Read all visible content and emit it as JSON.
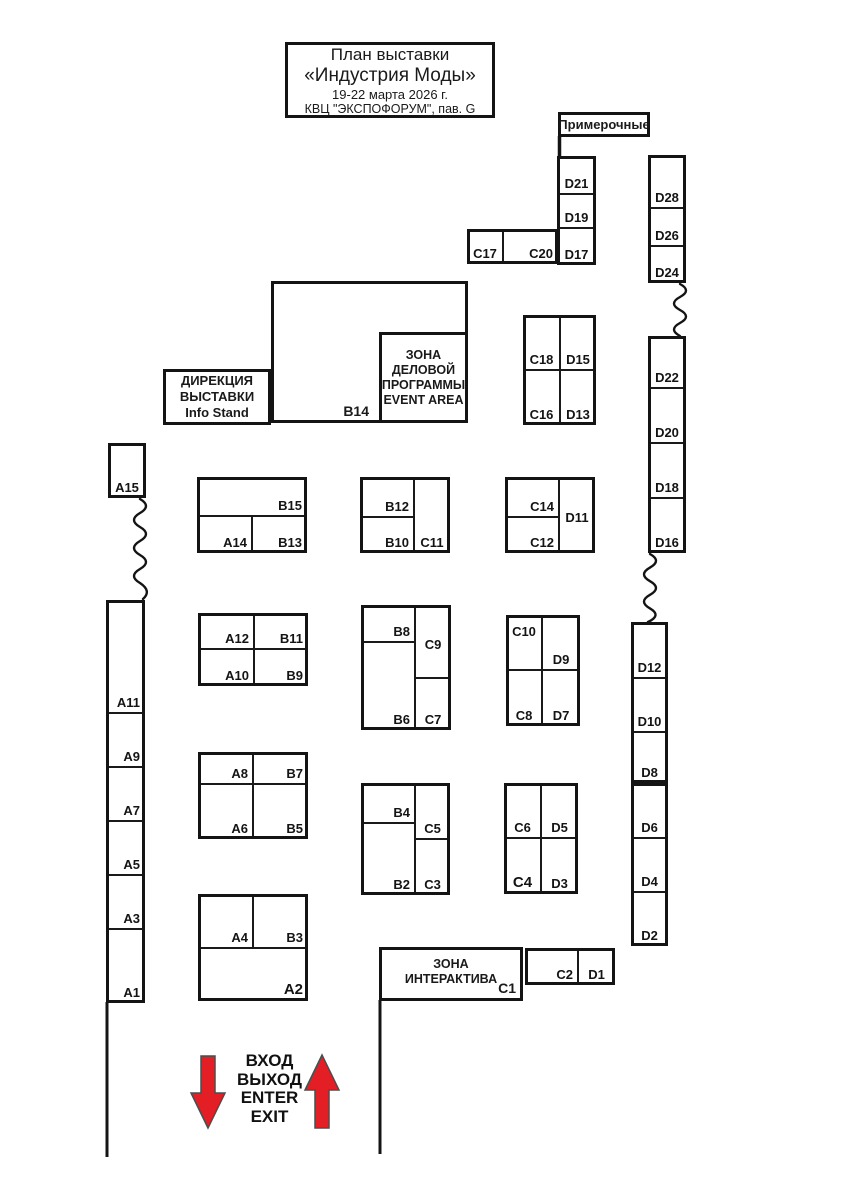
{
  "title": {
    "line1": "План выставки",
    "line2": "«Индустрия Моды»",
    "line3": "19-22 марта 2026 г.",
    "line4": "КВЦ \"ЭКСПОФОРУМ\", пав. G"
  },
  "labels": {
    "dressing_rooms": "Примерочные",
    "direction_line1": "ДИРЕКЦИЯ",
    "direction_line2": "ВЫСТАВКИ",
    "direction_line3": "Info Stand",
    "event_line1": "ЗОНА",
    "event_line2": "ДЕЛОВОЙ",
    "event_line3": "ПРОГРАММЫ",
    "event_line4": "EVENT AREA",
    "interactive_line1": "ЗОНА",
    "interactive_line2": "ИНТЕРАКТИВА",
    "interactive_booth": "C1",
    "b14": "B14",
    "entrance_line1": "ВХОД",
    "entrance_line2": "ВЫХОД",
    "entrance_line3": "ENTER",
    "entrance_line4": "EXIT"
  },
  "colors": {
    "accent_red": "#e31e24",
    "ink": "#141414",
    "background": "#ffffff"
  },
  "blocks": [
    {
      "name": "d21-column",
      "rect": [
        557,
        156,
        39,
        109
      ],
      "cells": [
        {
          "id": "D21",
          "rect": [
            557,
            156,
            39,
            38
          ],
          "pos": "bc"
        },
        {
          "id": "D19",
          "rect": [
            557,
            194,
            39,
            34
          ],
          "pos": "bc"
        },
        {
          "id": "D17",
          "rect": [
            557,
            228,
            39,
            37
          ],
          "pos": "bc"
        }
      ]
    },
    {
      "name": "c17-block",
      "rect": [
        467,
        229,
        91,
        35
      ],
      "cells": [
        {
          "id": "C17",
          "rect": [
            467,
            229,
            36,
            35
          ],
          "pos": "bc"
        },
        {
          "id": "C20",
          "rect": [
            503,
            229,
            55,
            35
          ],
          "pos": "br"
        }
      ]
    },
    {
      "name": "d28-column",
      "rect": [
        648,
        155,
        38,
        128
      ],
      "cells": [
        {
          "id": "D28",
          "rect": [
            648,
            155,
            38,
            53
          ],
          "pos": "bc"
        },
        {
          "id": "D26",
          "rect": [
            648,
            208,
            38,
            38
          ],
          "pos": "bc"
        },
        {
          "id": "D24",
          "rect": [
            648,
            246,
            38,
            37
          ],
          "pos": "bc"
        }
      ]
    },
    {
      "name": "d22-column",
      "rect": [
        648,
        336,
        38,
        217
      ],
      "cells": [
        {
          "id": "D22",
          "rect": [
            648,
            336,
            38,
            52
          ],
          "pos": "bc"
        },
        {
          "id": "D20",
          "rect": [
            648,
            388,
            38,
            55
          ],
          "pos": "bc"
        },
        {
          "id": "D18",
          "rect": [
            648,
            443,
            38,
            55
          ],
          "pos": "bc"
        },
        {
          "id": "D16",
          "rect": [
            648,
            498,
            38,
            55
          ],
          "pos": "bc"
        }
      ]
    },
    {
      "name": "d12-column",
      "rect": [
        631,
        622,
        37,
        161
      ],
      "cells": [
        {
          "id": "D12",
          "rect": [
            631,
            622,
            37,
            56
          ],
          "pos": "bc"
        },
        {
          "id": "D10",
          "rect": [
            631,
            678,
            37,
            54
          ],
          "pos": "bc"
        },
        {
          "id": "D8",
          "rect": [
            631,
            732,
            37,
            51
          ],
          "pos": "bc"
        }
      ]
    },
    {
      "name": "d6-column",
      "rect": [
        631,
        783,
        37,
        163
      ],
      "cells": [
        {
          "id": "D6",
          "rect": [
            631,
            783,
            37,
            55
          ],
          "pos": "bc"
        },
        {
          "id": "D4",
          "rect": [
            631,
            838,
            37,
            54
          ],
          "pos": "bc"
        },
        {
          "id": "D2",
          "rect": [
            631,
            892,
            37,
            54
          ],
          "pos": "bc"
        }
      ]
    },
    {
      "name": "c18-block",
      "rect": [
        523,
        315,
        73,
        110
      ],
      "cells": [
        {
          "id": "C18",
          "rect": [
            523,
            315,
            37,
            55
          ],
          "pos": "bc"
        },
        {
          "id": "D15",
          "rect": [
            560,
            315,
            36,
            55
          ],
          "pos": "bc"
        },
        {
          "id": "C16",
          "rect": [
            523,
            370,
            37,
            55
          ],
          "pos": "bc"
        },
        {
          "id": "D13",
          "rect": [
            560,
            370,
            36,
            55
          ],
          "pos": "bc"
        }
      ]
    },
    {
      "name": "a15-box",
      "rect": [
        108,
        443,
        38,
        55
      ],
      "cells": [
        {
          "id": "A15",
          "rect": [
            108,
            443,
            38,
            55
          ],
          "pos": "bc"
        }
      ]
    },
    {
      "name": "a-column",
      "rect": [
        106,
        600,
        39,
        403
      ],
      "cells": [
        {
          "id": "A11",
          "rect": [
            106,
            600,
            39,
            113
          ],
          "pos": "br"
        },
        {
          "id": "A9",
          "rect": [
            106,
            713,
            39,
            54
          ],
          "pos": "br"
        },
        {
          "id": "A7",
          "rect": [
            106,
            767,
            39,
            54
          ],
          "pos": "br"
        },
        {
          "id": "A5",
          "rect": [
            106,
            821,
            39,
            54
          ],
          "pos": "br"
        },
        {
          "id": "A3",
          "rect": [
            106,
            875,
            39,
            54
          ],
          "pos": "br"
        },
        {
          "id": "A1",
          "rect": [
            106,
            929,
            39,
            74
          ],
          "pos": "br"
        }
      ]
    },
    {
      "name": "row1-block1",
      "rect": [
        197,
        477,
        110,
        76
      ],
      "cells": [
        {
          "id": "B15",
          "rect": [
            197,
            477,
            110,
            39
          ],
          "pos": "br"
        },
        {
          "id": "A14",
          "rect": [
            197,
            516,
            55,
            37
          ],
          "pos": "br"
        },
        {
          "id": "B13",
          "rect": [
            252,
            516,
            55,
            37
          ],
          "pos": "br"
        }
      ]
    },
    {
      "name": "row1-block2",
      "rect": [
        360,
        477,
        90,
        76
      ],
      "cells": [
        {
          "id": "B12",
          "rect": [
            360,
            477,
            54,
            40
          ],
          "pos": "br"
        },
        {
          "id": "B10",
          "rect": [
            360,
            517,
            54,
            36
          ],
          "pos": "br"
        },
        {
          "id": "C11",
          "rect": [
            414,
            477,
            36,
            76
          ],
          "pos": "bc"
        }
      ]
    },
    {
      "name": "row1-block3",
      "rect": [
        505,
        477,
        90,
        76
      ],
      "cells": [
        {
          "id": "C14",
          "rect": [
            505,
            477,
            54,
            40
          ],
          "pos": "br"
        },
        {
          "id": "C12",
          "rect": [
            505,
            517,
            54,
            36
          ],
          "pos": "br"
        },
        {
          "id": "D11",
          "rect": [
            559,
            477,
            36,
            76
          ],
          "pos": "c"
        }
      ]
    },
    {
      "name": "row2-block1",
      "rect": [
        198,
        613,
        110,
        73
      ],
      "cells": [
        {
          "id": "A12",
          "rect": [
            198,
            613,
            56,
            36
          ],
          "pos": "br"
        },
        {
          "id": "B11",
          "rect": [
            254,
            613,
            54,
            36
          ],
          "pos": "br"
        },
        {
          "id": "A10",
          "rect": [
            198,
            649,
            56,
            37
          ],
          "pos": "br"
        },
        {
          "id": "B9",
          "rect": [
            254,
            649,
            54,
            37
          ],
          "pos": "br"
        }
      ]
    },
    {
      "name": "row2-block2",
      "rect": [
        361,
        605,
        90,
        125
      ],
      "cells": [
        {
          "id": "B8",
          "rect": [
            361,
            605,
            54,
            37
          ],
          "pos": "br"
        },
        {
          "id": "B6",
          "rect": [
            361,
            642,
            54,
            88
          ],
          "pos": "br"
        },
        {
          "id": "C9",
          "rect": [
            415,
            605,
            36,
            73
          ],
          "pos": "c"
        },
        {
          "id": "C7",
          "rect": [
            415,
            678,
            36,
            52
          ],
          "pos": "bc"
        }
      ]
    },
    {
      "name": "row2-block3",
      "rect": [
        506,
        615,
        74,
        111
      ],
      "cells": [
        {
          "id": "C10",
          "rect": [
            506,
            615,
            36,
            55
          ],
          "pos": "tc"
        },
        {
          "id": "D9",
          "rect": [
            542,
            615,
            38,
            55
          ],
          "pos": "bc"
        },
        {
          "id": "C8",
          "rect": [
            506,
            670,
            36,
            56
          ],
          "pos": "bc"
        },
        {
          "id": "D7",
          "rect": [
            542,
            670,
            38,
            56
          ],
          "pos": "bc"
        }
      ]
    },
    {
      "name": "row3-block1",
      "rect": [
        198,
        752,
        110,
        87
      ],
      "cells": [
        {
          "id": "A8",
          "rect": [
            198,
            752,
            55,
            32
          ],
          "pos": "br"
        },
        {
          "id": "B7",
          "rect": [
            253,
            752,
            55,
            32
          ],
          "pos": "br"
        },
        {
          "id": "A6",
          "rect": [
            198,
            784,
            55,
            55
          ],
          "pos": "br"
        },
        {
          "id": "B5",
          "rect": [
            253,
            784,
            55,
            55
          ],
          "pos": "br"
        }
      ]
    },
    {
      "name": "row3-block2",
      "rect": [
        361,
        783,
        89,
        112
      ],
      "cells": [
        {
          "id": "B4",
          "rect": [
            361,
            783,
            54,
            40
          ],
          "pos": "br"
        },
        {
          "id": "B2",
          "rect": [
            361,
            823,
            54,
            72
          ],
          "pos": "br"
        },
        {
          "id": "C5",
          "rect": [
            415,
            783,
            35,
            56
          ],
          "pos": "bc"
        },
        {
          "id": "C3",
          "rect": [
            415,
            839,
            35,
            56
          ],
          "pos": "bc"
        }
      ]
    },
    {
      "name": "row3-block3",
      "rect": [
        504,
        783,
        74,
        111
      ],
      "cells": [
        {
          "id": "C6",
          "rect": [
            504,
            783,
            37,
            55
          ],
          "pos": "bc"
        },
        {
          "id": "D5",
          "rect": [
            541,
            783,
            37,
            55
          ],
          "pos": "bc"
        },
        {
          "id": "C4",
          "rect": [
            504,
            838,
            37,
            56
          ],
          "pos": "bc lg"
        },
        {
          "id": "D3",
          "rect": [
            541,
            838,
            37,
            56
          ],
          "pos": "bc"
        }
      ]
    },
    {
      "name": "row4-block1",
      "rect": [
        198,
        894,
        110,
        107
      ],
      "cells": [
        {
          "id": "A4",
          "rect": [
            198,
            894,
            55,
            54
          ],
          "pos": "br"
        },
        {
          "id": "B3",
          "rect": [
            253,
            894,
            55,
            54
          ],
          "pos": "br"
        },
        {
          "id": "A2",
          "rect": [
            198,
            948,
            110,
            53
          ],
          "pos": "br lg"
        }
      ]
    },
    {
      "name": "c2-d1-block",
      "rect": [
        525,
        948,
        90,
        37
      ],
      "cells": [
        {
          "id": "C2",
          "rect": [
            525,
            948,
            53,
            37
          ],
          "pos": "br"
        },
        {
          "id": "D1",
          "rect": [
            578,
            948,
            37,
            37
          ],
          "pos": "bc"
        }
      ]
    }
  ]
}
